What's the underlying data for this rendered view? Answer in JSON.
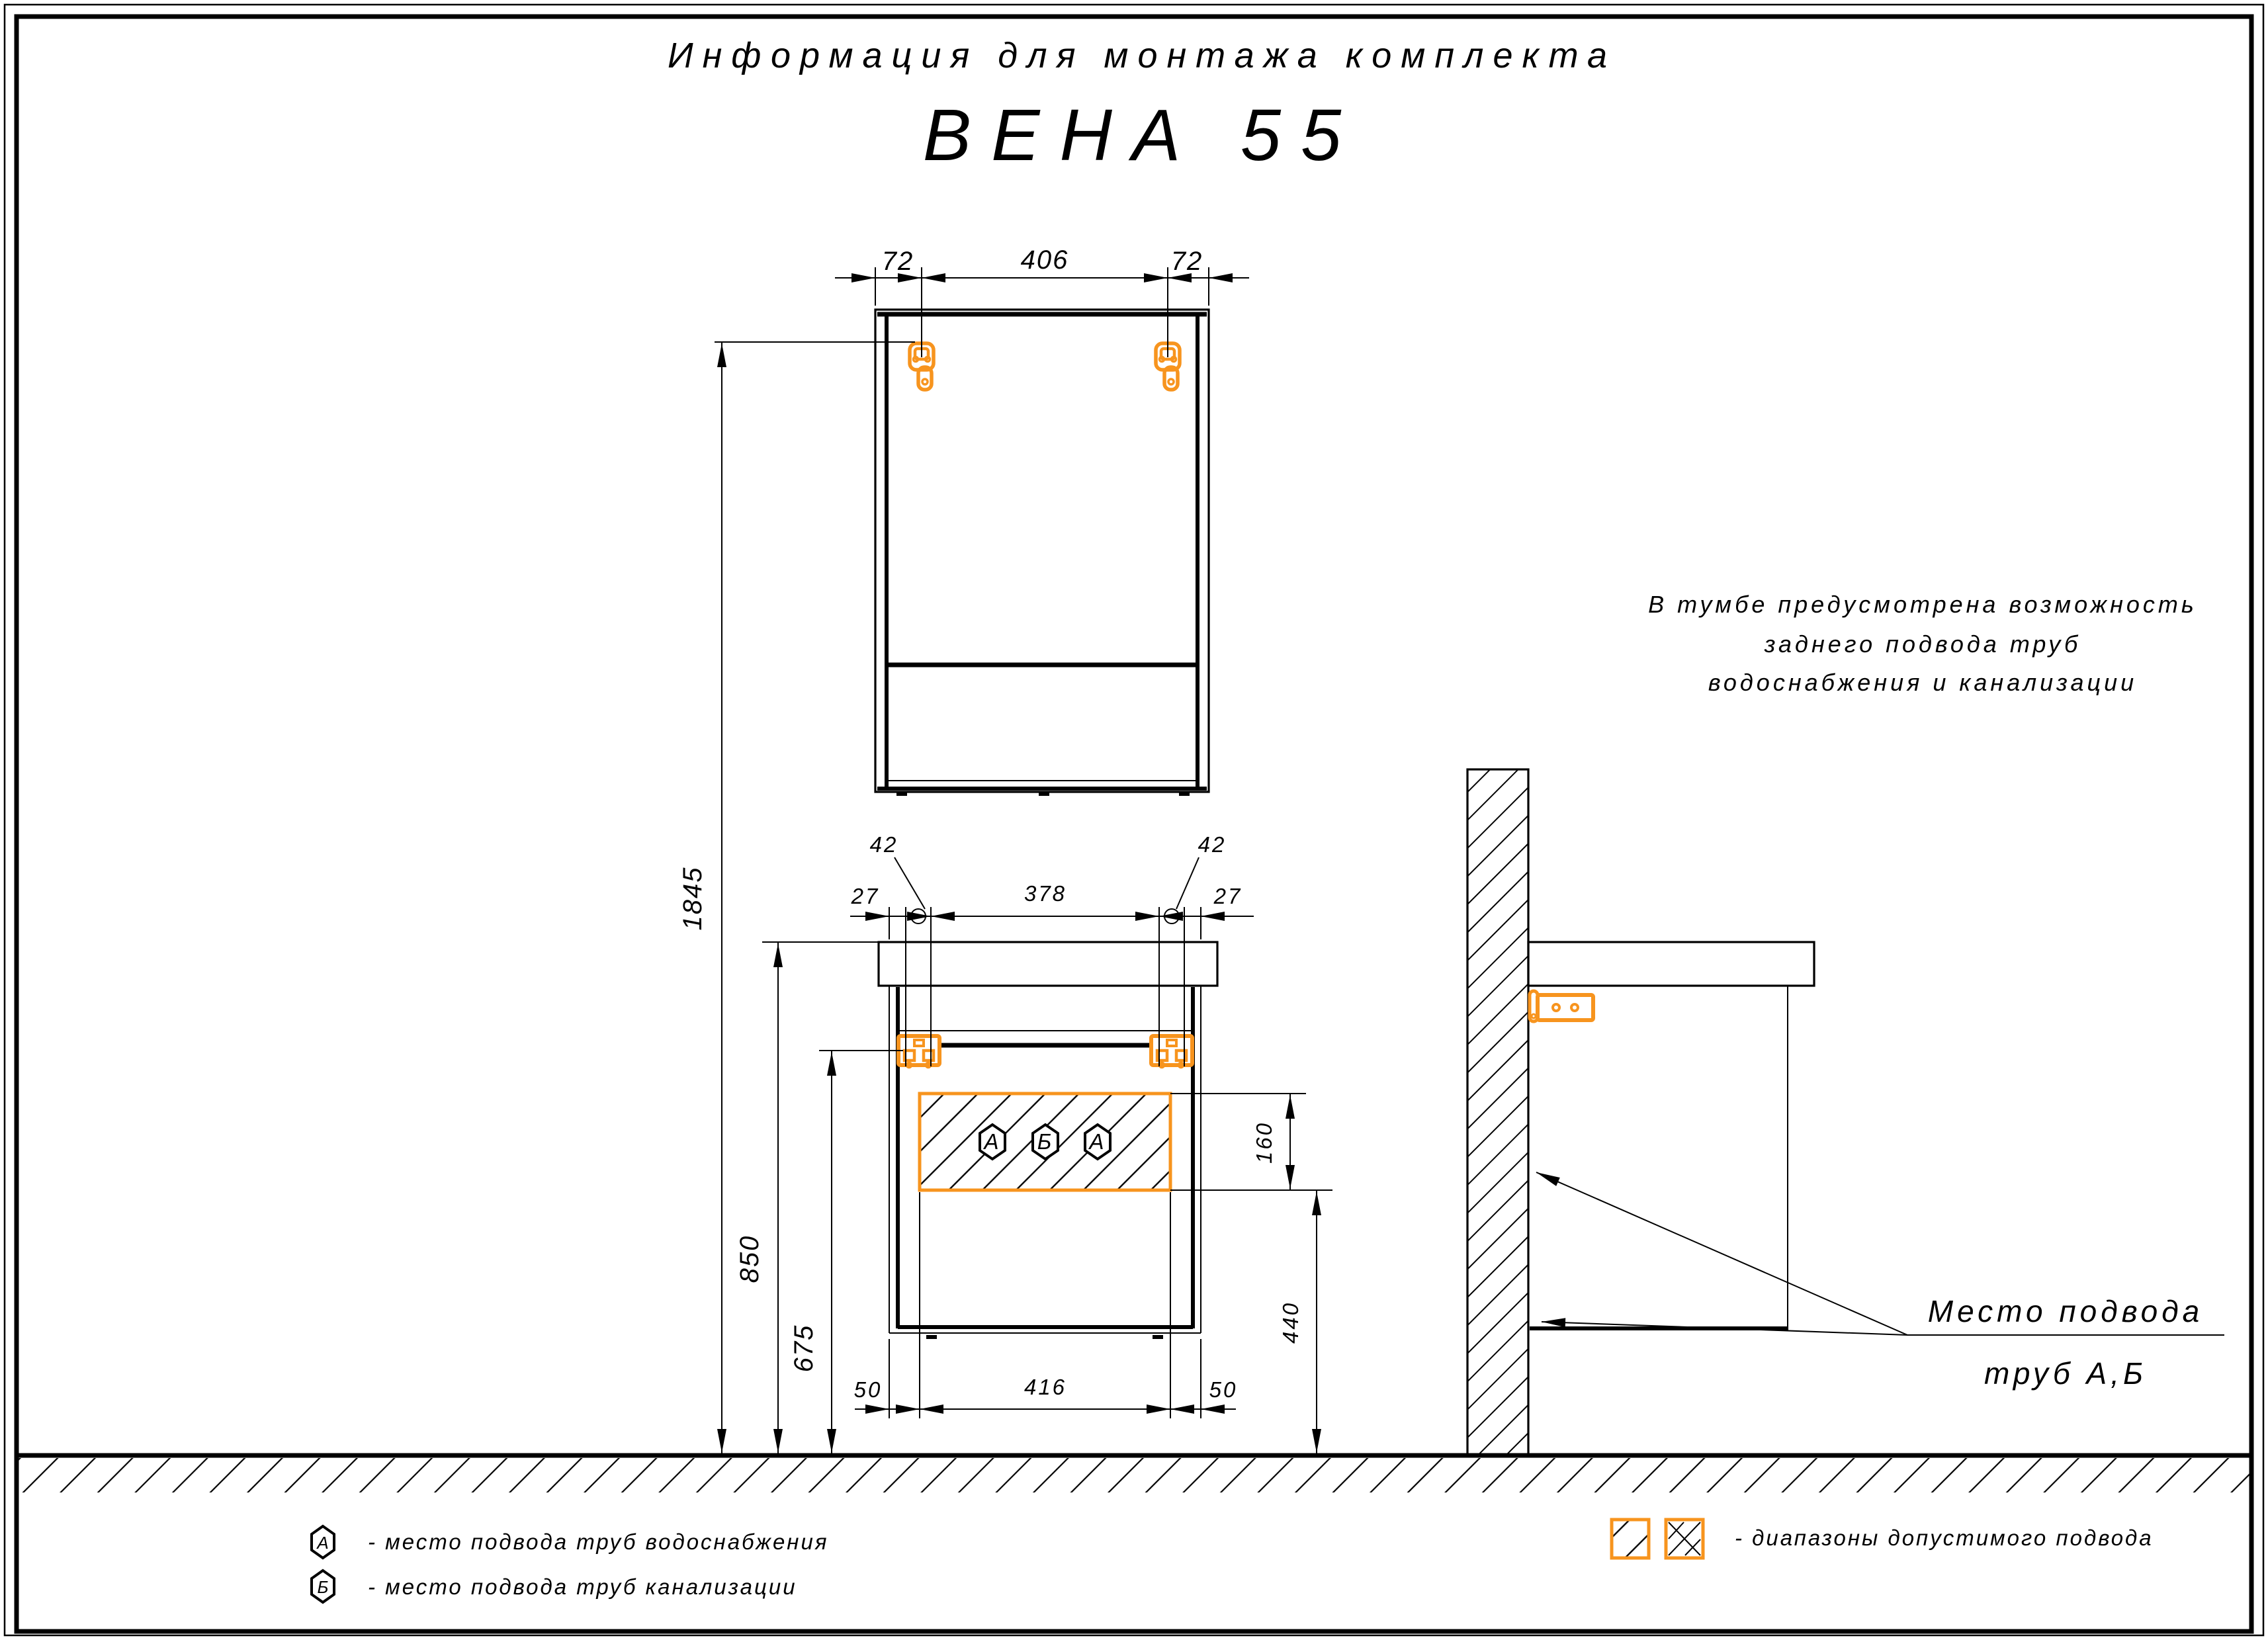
{
  "colors": {
    "line": "#000000",
    "accent_orange": "#F7941E",
    "background": "#ffffff"
  },
  "header": {
    "title": "Информация для монтажа комплекта",
    "model": "ВЕНА 55"
  },
  "mirror_view": {
    "dim_left": "72",
    "dim_span": "406",
    "dim_right": "72"
  },
  "heights": {
    "mirror_bracket": "1845",
    "countertop": "850",
    "vanity_bracket": "675"
  },
  "vanity_view": {
    "dim_offset_left": "27",
    "dim_hole_left": "42",
    "dim_span": "378",
    "dim_hole_right": "42",
    "dim_offset_right": "27",
    "zone_height": "160",
    "zone_bottom": "440",
    "dim_bottom_left": "50",
    "dim_bottom_span": "416",
    "dim_bottom_right": "50",
    "zone_markers": [
      "А",
      "Б",
      "А"
    ]
  },
  "note": {
    "line1": "В тумбе предусмотрена возможность",
    "line2": "заднего подвода труб",
    "line3": "водоснабжения и канализации"
  },
  "pipe_callout": {
    "line1": "Место подвода",
    "line2": "труб А,Б"
  },
  "legend": {
    "water": {
      "marker": "А",
      "text": "- место подвода труб водоснабжения"
    },
    "sewer": {
      "marker": "Б",
      "text": "- место подвода труб канализации"
    },
    "ranges": {
      "text": "- диапазоны допустимого подвода"
    }
  }
}
